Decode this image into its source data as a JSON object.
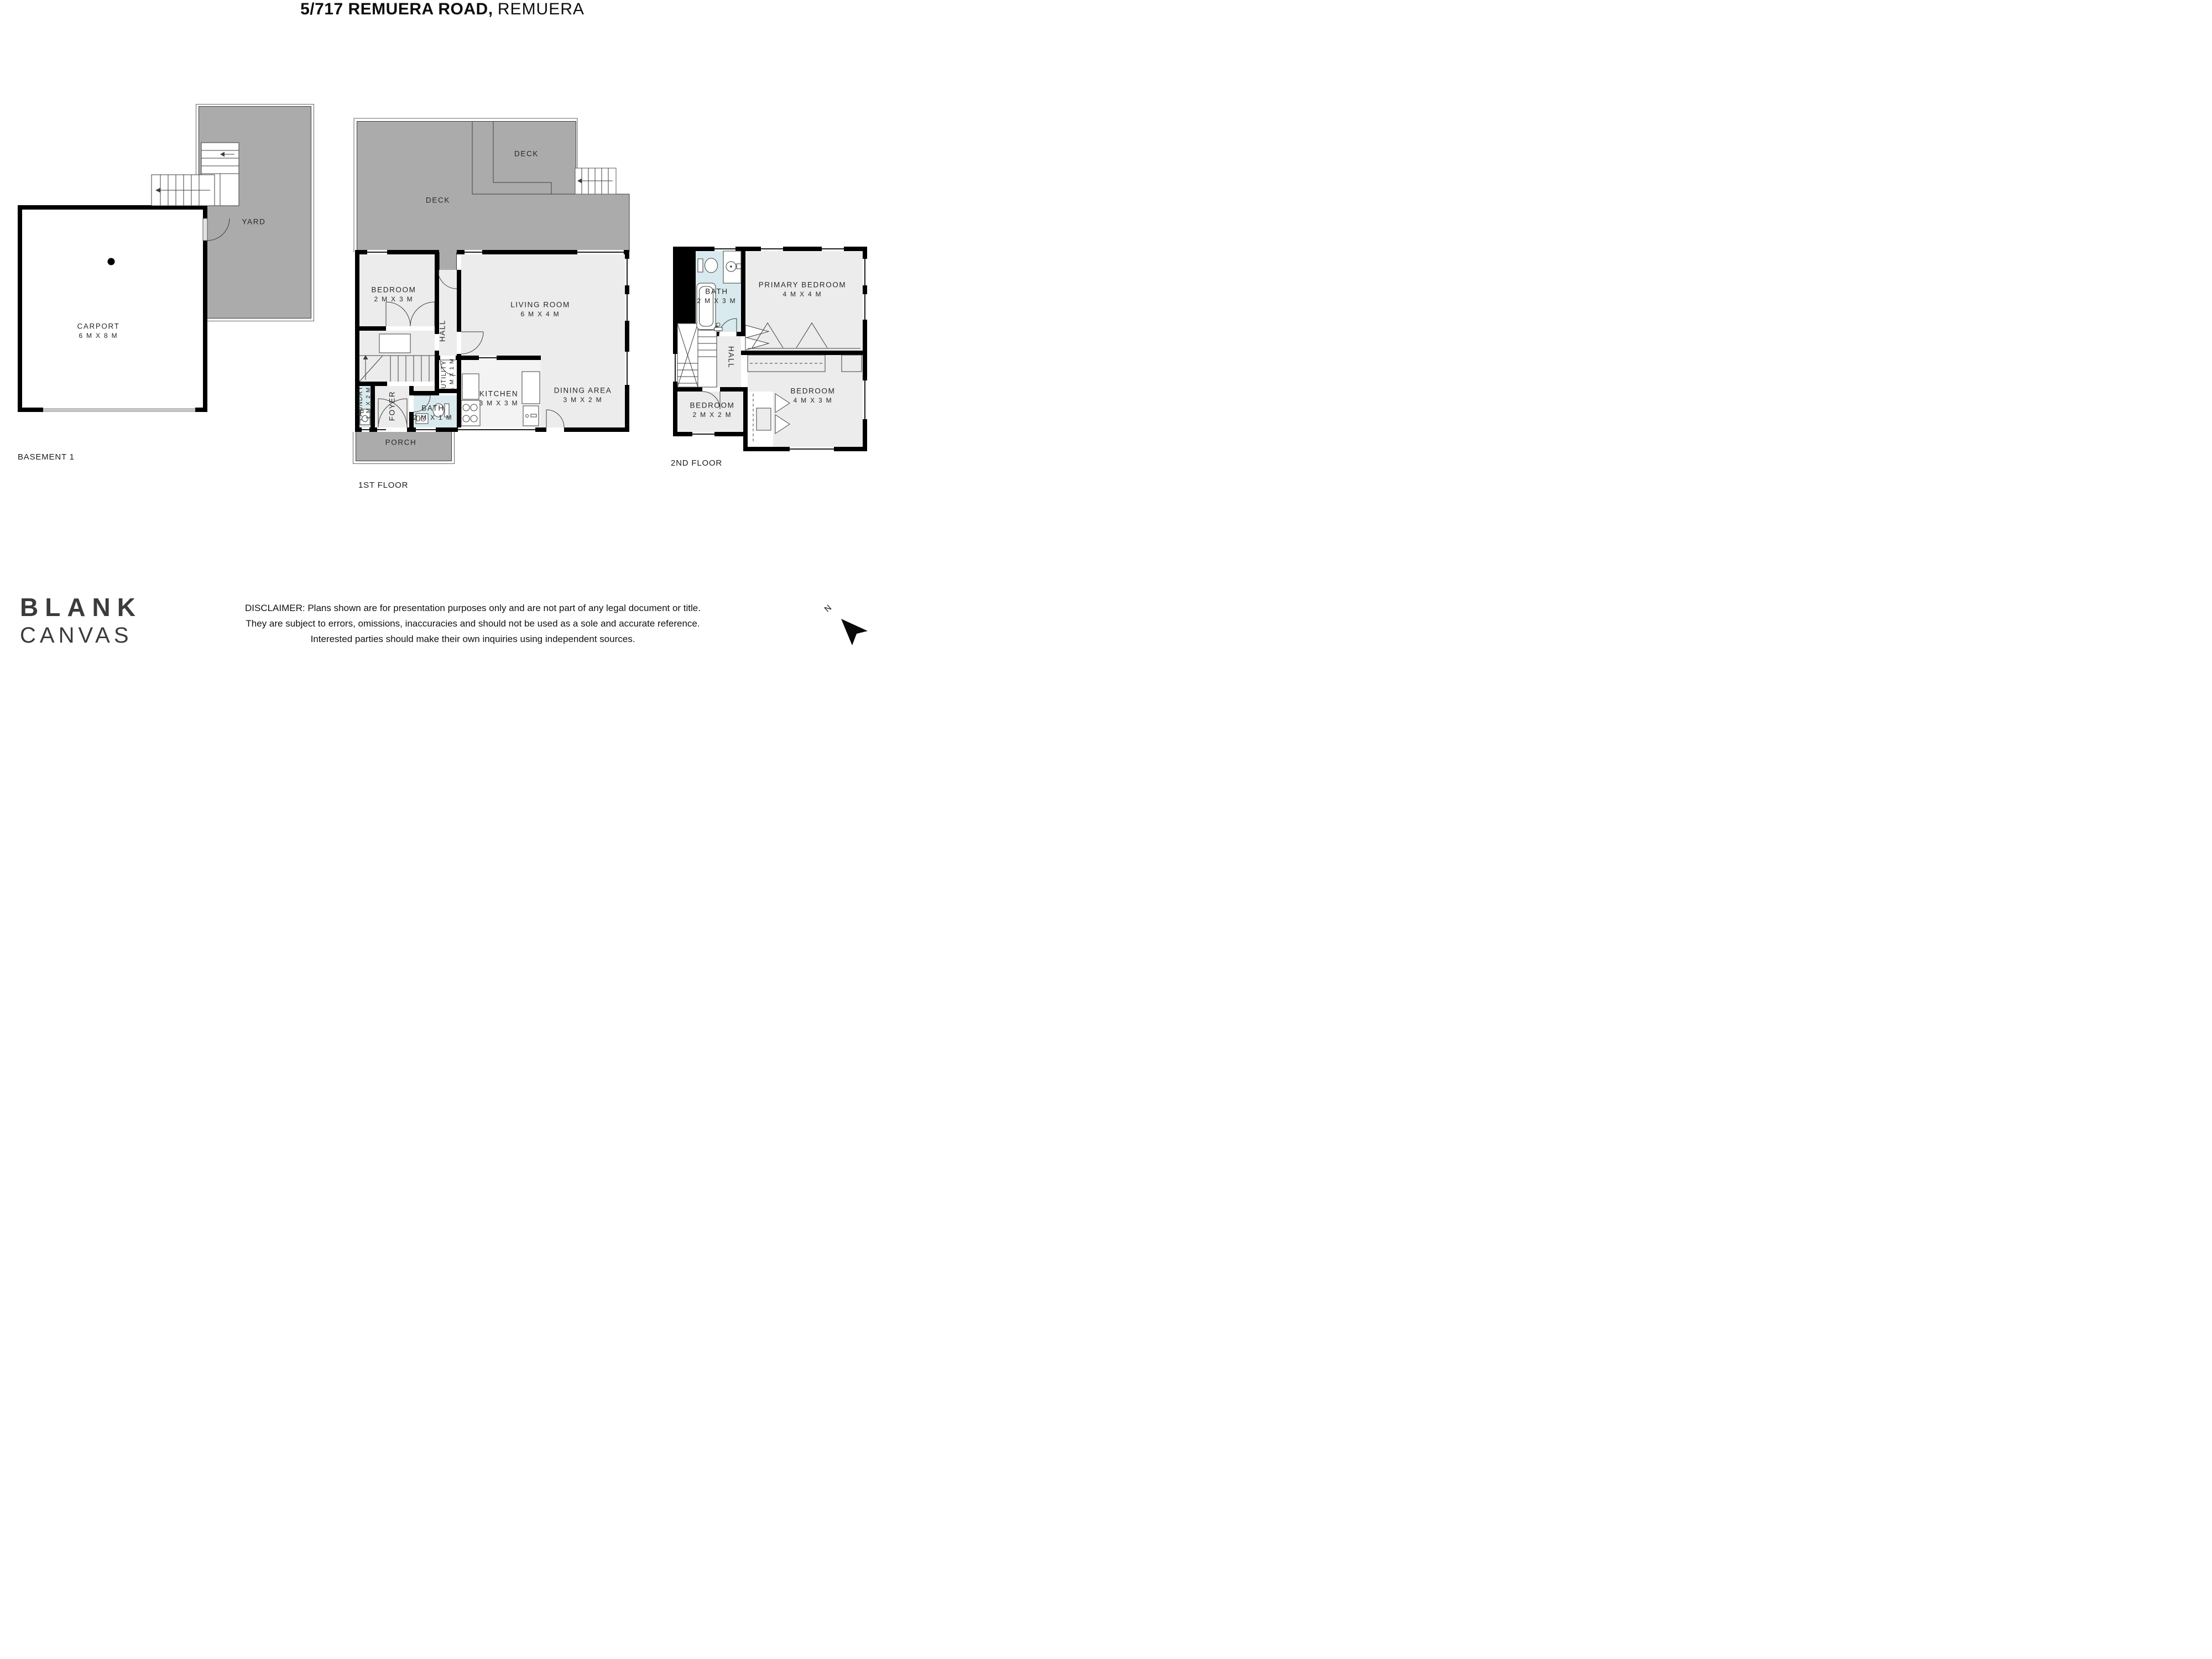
{
  "colors": {
    "wall": "#000000",
    "deck_gray": "#ababab",
    "room_fill": "#ececec",
    "kitchen_fill": "#f3f3f3",
    "wet_room_fill": "#d8eaee"
  },
  "title": {
    "bold": "5/717 REMUERA ROAD,",
    "light": "REMUERA"
  },
  "disclaimer": {
    "line1": "DISCLAIMER: Plans shown are for presentation purposes only and are not part of any legal document or title.",
    "line2": "They are subject to errors, omissions, inaccuracies and should not be used as a sole and accurate reference.",
    "line3": "Interested parties should make their own inquiries using independent sources."
  },
  "logo": {
    "line1": "BLANK",
    "line2": "CANVAS"
  },
  "compass": {
    "label": "N"
  },
  "plans": {
    "basement": {
      "floor_label": "BASEMENT 1",
      "rooms": {
        "carport": {
          "name": "CARPORT",
          "dims": "6 M X 8 M"
        },
        "yard": {
          "name": "YARD"
        }
      }
    },
    "first": {
      "floor_label": "1ST FLOOR",
      "rooms": {
        "deck_upper": {
          "name": "DECK"
        },
        "deck_lower": {
          "name": "DECK"
        },
        "bedroom": {
          "name": "BEDROOM",
          "dims": "2 M X 3 M"
        },
        "living_room": {
          "name": "LIVING ROOM",
          "dims": "6 M X 4 M"
        },
        "hall": {
          "name": "HALL"
        },
        "utility": {
          "name": "UTILITY",
          "dims": "1 M X 1 M"
        },
        "kitchen": {
          "name": "KITCHEN",
          "dims": "3 M X 3 M"
        },
        "dining": {
          "name": "DINING AREA",
          "dims": "3 M X 2 M"
        },
        "laundry": {
          "name": "LAUNDRY",
          "dims": "1 M X 2 M"
        },
        "foyer": {
          "name": "FOYER"
        },
        "bath": {
          "name": "BATH",
          "dims": "2 M X 1 M"
        },
        "porch": {
          "name": "PORCH"
        }
      }
    },
    "second": {
      "floor_label": "2ND FLOOR",
      "rooms": {
        "bath": {
          "name": "BATH",
          "dims": "2 M X 3 M"
        },
        "primary_bedroom": {
          "name": "PRIMARY BEDROOM",
          "dims": "4 M X 4 M"
        },
        "hall": {
          "name": "HALL"
        },
        "bedroom_small": {
          "name": "BEDROOM",
          "dims": "2 M X 2 M"
        },
        "bedroom_large": {
          "name": "BEDROOM",
          "dims": "4 M X 3 M"
        }
      }
    }
  }
}
